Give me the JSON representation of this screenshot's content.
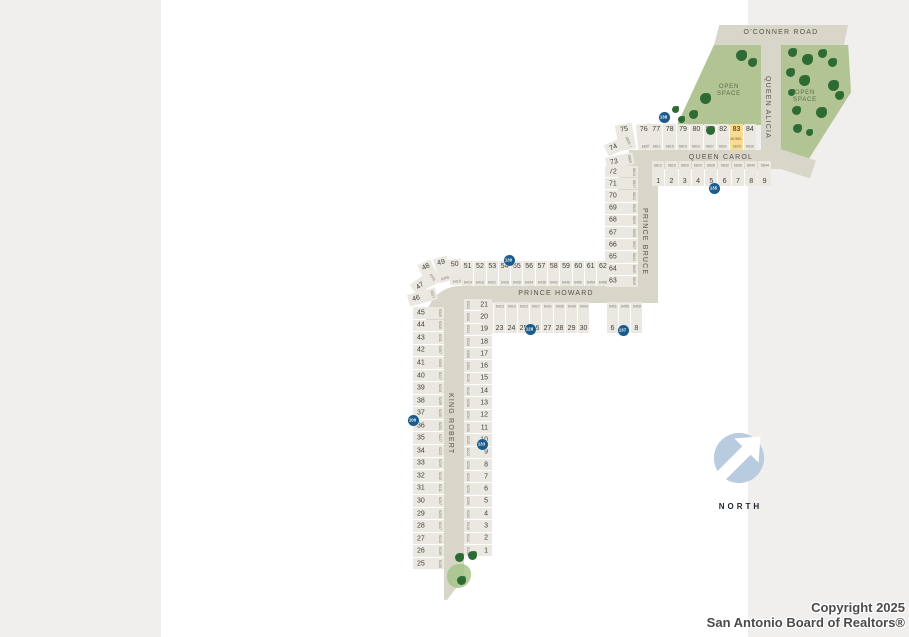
{
  "map": {
    "roads": {
      "oconner": "O'CONNER ROAD",
      "queen_alicia": "QUEEN ALICIA",
      "queen_carol": "QUEEN CAROL",
      "prince_bruce": "PRINCE BRUCE",
      "prince_howard": "PRINCE HOWARD",
      "king_robert": "KING ROBERT"
    },
    "open_space_label": "OPEN SPACE",
    "model_label": "MODEL",
    "north_label": "NORTH",
    "badges": [
      {
        "value": "138"
      },
      {
        "value": "135"
      },
      {
        "value": "130"
      },
      {
        "value": "128"
      },
      {
        "value": "137"
      },
      {
        "value": "100"
      },
      {
        "value": "133"
      }
    ],
    "lot_groups": {
      "qc_north": {
        "lots": [
          {
            "num": "77",
            "addr": "6811"
          },
          {
            "num": "78",
            "addr": "6815"
          },
          {
            "num": "79",
            "addr": "6819"
          },
          {
            "num": "80",
            "addr": "6823"
          },
          {
            "num": "81",
            "addr": "6827"
          },
          {
            "num": "82",
            "addr": "6831"
          },
          {
            "num": "83",
            "addr": "6835",
            "model": true
          },
          {
            "num": "84",
            "addr": "6839"
          }
        ]
      },
      "qc_south": {
        "lots": [
          {
            "num": "1",
            "addr": "6812"
          },
          {
            "num": "2",
            "addr": "6816"
          },
          {
            "num": "3",
            "addr": "6820"
          },
          {
            "num": "4",
            "addr": "6824"
          },
          {
            "num": "5",
            "addr": "6828"
          },
          {
            "num": "6",
            "addr": "6832"
          },
          {
            "num": "7",
            "addr": "6836"
          },
          {
            "num": "8",
            "addr": "6840"
          },
          {
            "num": "9",
            "addr": "6844"
          }
        ]
      },
      "pb_west": {
        "lots": [
          {
            "num": "72",
            "addr": "6813"
          },
          {
            "num": "71",
            "addr": "6817"
          },
          {
            "num": "70",
            "addr": "6821"
          },
          {
            "num": "69",
            "addr": "6825"
          },
          {
            "num": "68",
            "addr": "6829"
          },
          {
            "num": "67",
            "addr": "6833"
          },
          {
            "num": "66",
            "addr": "6837"
          },
          {
            "num": "65",
            "addr": "6841"
          },
          {
            "num": "64",
            "addr": "6845"
          },
          {
            "num": "63",
            "addr": "6849"
          }
        ]
      },
      "ph_north": {
        "lots": [
          {
            "num": "51",
            "addr": "6414"
          },
          {
            "num": "52",
            "addr": "6418"
          },
          {
            "num": "53",
            "addr": "6422"
          },
          {
            "num": "54",
            "addr": "6426"
          },
          {
            "num": "55",
            "addr": "6430"
          },
          {
            "num": "56",
            "addr": "6434"
          },
          {
            "num": "57",
            "addr": "6438"
          },
          {
            "num": "58",
            "addr": "6442"
          },
          {
            "num": "59",
            "addr": "6446"
          },
          {
            "num": "60",
            "addr": "6450"
          },
          {
            "num": "61",
            "addr": "6454"
          },
          {
            "num": "62",
            "addr": "6458"
          }
        ]
      },
      "ph_south": {
        "lots": [
          {
            "num": "22",
            "addr": "6411"
          },
          {
            "num": "23",
            "addr": "6415"
          },
          {
            "num": "24",
            "addr": "6419"
          },
          {
            "num": "25",
            "addr": "6423"
          },
          {
            "num": "26",
            "addr": "6427"
          },
          {
            "num": "27",
            "addr": "6431"
          },
          {
            "num": "28",
            "addr": "6435"
          },
          {
            "num": "29",
            "addr": "6439"
          },
          {
            "num": "30",
            "addr": "6443"
          }
        ]
      },
      "ph_south_east": {
        "lots": [
          {
            "num": "6",
            "addr": "6451"
          },
          {
            "num": "7",
            "addr": "6455"
          },
          {
            "num": "8",
            "addr": "6459"
          }
        ]
      },
      "kr_west": {
        "lots": [
          {
            "num": "45",
            "addr": "6319"
          },
          {
            "num": "44",
            "addr": "6315"
          },
          {
            "num": "43",
            "addr": "6311"
          },
          {
            "num": "42",
            "addr": "6307"
          },
          {
            "num": "41",
            "addr": "6303"
          },
          {
            "num": "40",
            "addr": "6247"
          },
          {
            "num": "39",
            "addr": "6243"
          },
          {
            "num": "38",
            "addr": "6239"
          },
          {
            "num": "37",
            "addr": "6235"
          },
          {
            "num": "36",
            "addr": "6231"
          },
          {
            "num": "35",
            "addr": "6227"
          },
          {
            "num": "34",
            "addr": "6223"
          },
          {
            "num": "33",
            "addr": "6219"
          },
          {
            "num": "32",
            "addr": "6215"
          },
          {
            "num": "31",
            "addr": "6211"
          },
          {
            "num": "30",
            "addr": "6207"
          },
          {
            "num": "29",
            "addr": "6203"
          },
          {
            "num": "28",
            "addr": "6147"
          },
          {
            "num": "27",
            "addr": "6143"
          },
          {
            "num": "26",
            "addr": "6139"
          },
          {
            "num": "25",
            "addr": "6135"
          }
        ]
      },
      "kr_east": {
        "lots": [
          {
            "num": "21",
            "addr": "6322"
          },
          {
            "num": "20",
            "addr": "6318"
          },
          {
            "num": "19",
            "addr": "6314"
          },
          {
            "num": "18",
            "addr": "6310"
          },
          {
            "num": "17",
            "addr": "6306"
          },
          {
            "num": "16",
            "addr": "6302"
          },
          {
            "num": "15",
            "addr": "6246"
          },
          {
            "num": "14",
            "addr": "6242"
          },
          {
            "num": "13",
            "addr": "6238"
          },
          {
            "num": "12",
            "addr": "6234"
          },
          {
            "num": "11",
            "addr": "6230"
          },
          {
            "num": "10",
            "addr": "6226"
          },
          {
            "num": "9",
            "addr": "6222"
          },
          {
            "num": "8",
            "addr": "6218"
          },
          {
            "num": "7",
            "addr": "6214"
          },
          {
            "num": "6",
            "addr": "6210"
          },
          {
            "num": "5",
            "addr": "6206"
          },
          {
            "num": "4",
            "addr": "6202"
          },
          {
            "num": "3",
            "addr": "6146"
          },
          {
            "num": "2",
            "addr": "6142"
          },
          {
            "num": "1",
            "addr": "6138"
          }
        ]
      }
    },
    "wedge_lots": [
      {
        "num": "75",
        "addr": "6803"
      },
      {
        "num": "76",
        "addr": "6807"
      },
      {
        "num": "74",
        "addr": "6805"
      },
      {
        "num": "73",
        "addr": "6809"
      },
      {
        "num": "48",
        "addr": "6402"
      },
      {
        "num": "49",
        "addr": "6406"
      },
      {
        "num": "50",
        "addr": "6410"
      },
      {
        "num": "47",
        "addr": "6331"
      },
      {
        "num": "46",
        "addr": "6327"
      }
    ]
  },
  "footer": {
    "line1": "Copyright 2025",
    "line2": "San Antonio Board of Realtors®"
  },
  "colors": {
    "street": "#d8d6c8",
    "lot": "#eae8e1",
    "open": "#b2c493",
    "tree": "#2e6b34",
    "model": "#f6dd92",
    "badge": "#1a5b8c",
    "north": "#b9cbdf"
  }
}
